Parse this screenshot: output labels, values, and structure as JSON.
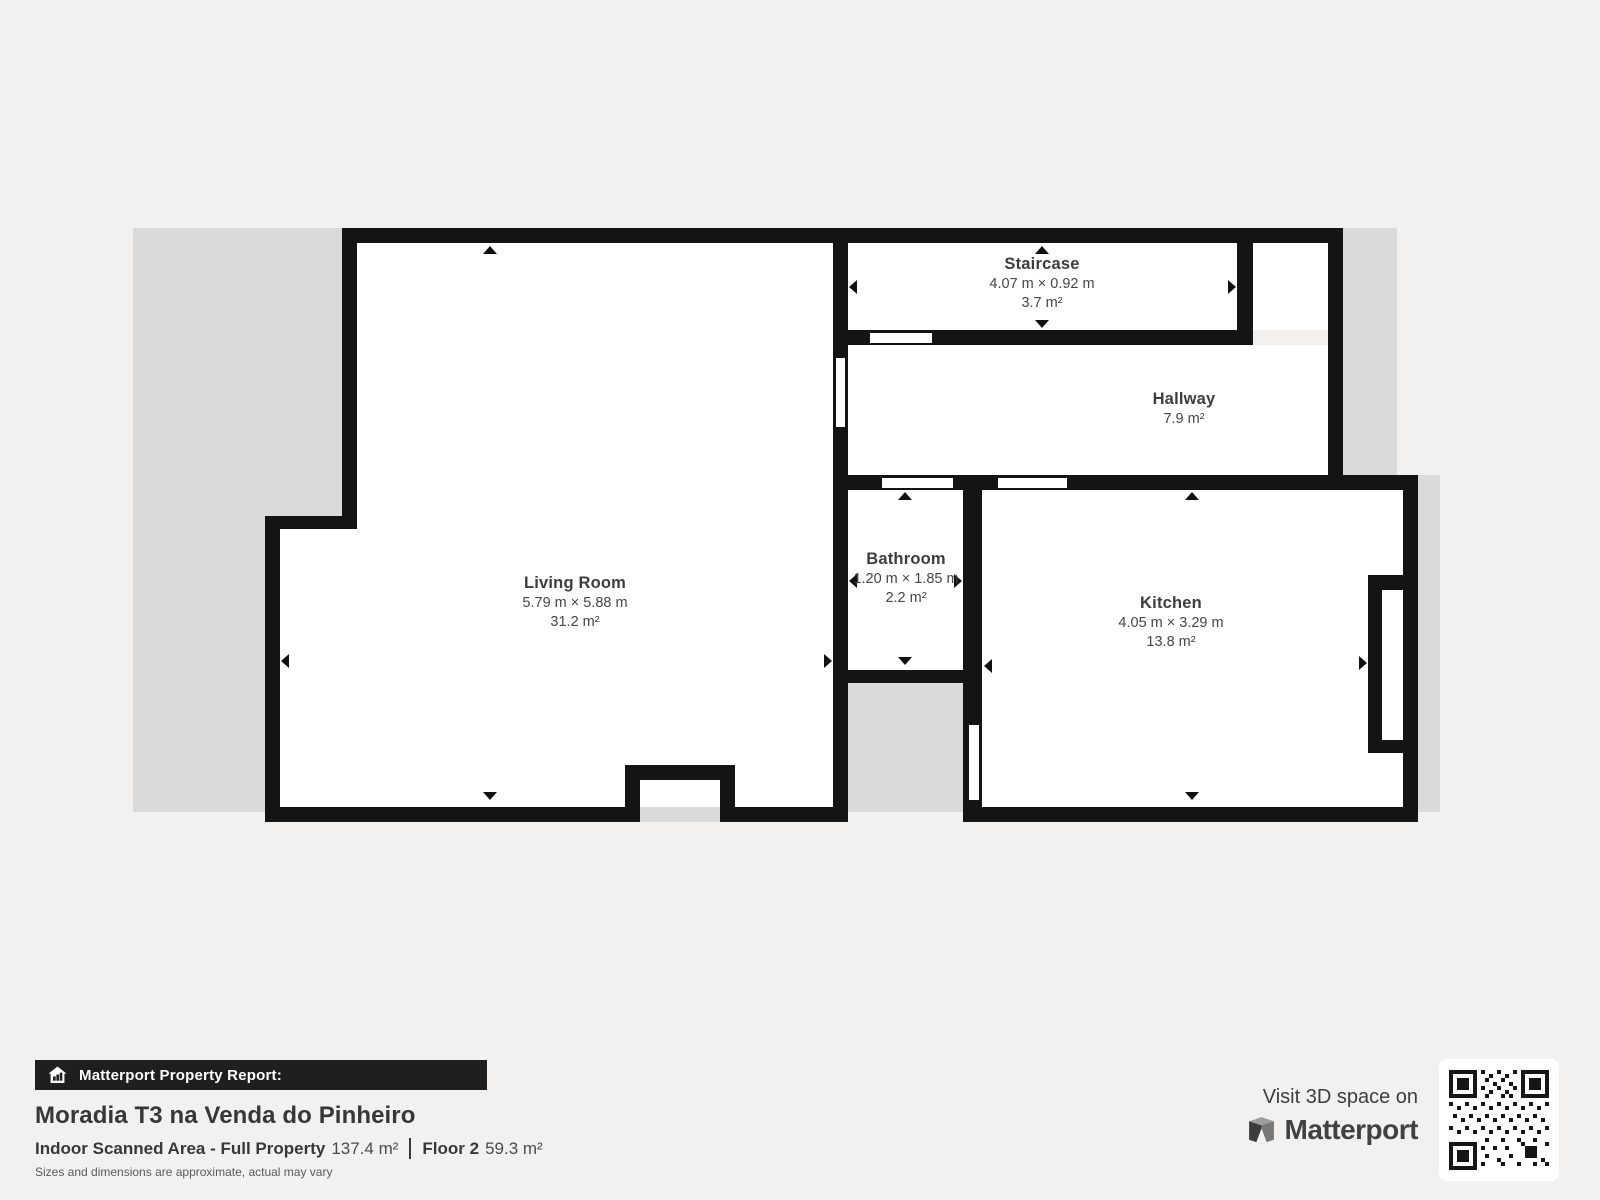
{
  "floor_plan": {
    "rooms": {
      "staircase": {
        "name": "Staircase",
        "dimensions": "4.07 m × 0.92 m",
        "area": "3.7 m²"
      },
      "hallway": {
        "name": "Hallway",
        "area": "7.9 m²"
      },
      "living_room": {
        "name": "Living Room",
        "dimensions": "5.79 m × 5.88 m",
        "area": "31.2 m²"
      },
      "bathroom": {
        "name": "Bathroom",
        "dimensions": "1.20 m × 1.85 m",
        "area": "2.2 m²"
      },
      "kitchen": {
        "name": "Kitchen",
        "dimensions": "4.05 m × 3.29 m",
        "area": "13.8 m²"
      }
    }
  },
  "report": {
    "badge_label": "Matterport Property Report:",
    "property_title": "Moradia T3 na Venda do Pinheiro",
    "indoor_area_label": "Indoor Scanned Area - Full Property",
    "indoor_area_value": "137.4 m²",
    "floor_label": "Floor 2",
    "floor_area_value": "59.3 m²",
    "disclaimer": "Sizes and dimensions are approximate, actual may vary"
  },
  "cta": {
    "visit_text": "Visit 3D space on",
    "brand": "Matterport"
  },
  "colors": {
    "background": "#f2f1ef",
    "underlay": "#dadada",
    "wall": "#141414",
    "room_fill": "#ffffff",
    "room_text": "#3d3d3d",
    "badge_bg": "#1f1f1f",
    "badge_text": "#ffffff"
  }
}
